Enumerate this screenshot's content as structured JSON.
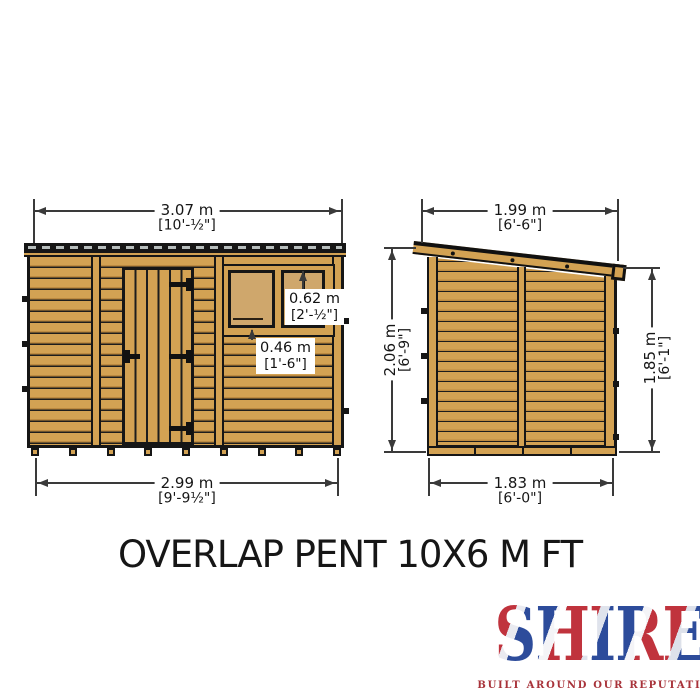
{
  "title": "OVERLAP PENT 10X6 M FT",
  "brand": {
    "name": "SHIRE",
    "tagline": "BUILT AROUND OUR REPUTATION"
  },
  "dimensions": {
    "front_top": {
      "metric": "3.07 m",
      "imperial": "[10'-½\"]"
    },
    "front_bottom": {
      "metric": "2.99 m",
      "imperial": "[9'-9½\"]"
    },
    "window_width": {
      "metric": "0.62 m",
      "imperial": "[2'-½\"]"
    },
    "window_height": {
      "metric": "0.46 m",
      "imperial": "[1'-6\"]"
    },
    "side_top": {
      "metric": "1.99 m",
      "imperial": "[6'-6\"]"
    },
    "side_bottom": {
      "metric": "1.83 m",
      "imperial": "[6'-0\"]"
    },
    "side_height_left": {
      "metric": "2.06 m",
      "imperial": "[6'-9\"]"
    },
    "side_height_right": {
      "metric": "1.85 m",
      "imperial": "[6'-1\"]"
    }
  },
  "colors": {
    "wood": "#d3a253",
    "wood_shadow": "#bd8a40",
    "outline": "#161616",
    "window_pane": "#cfa76c",
    "roof_dash": "#b7bebd",
    "dimension_line": "#3a3a3a",
    "brand_red": "#c0333d",
    "brand_blue": "#2d4c9b",
    "tagline_red": "#a8333a"
  }
}
